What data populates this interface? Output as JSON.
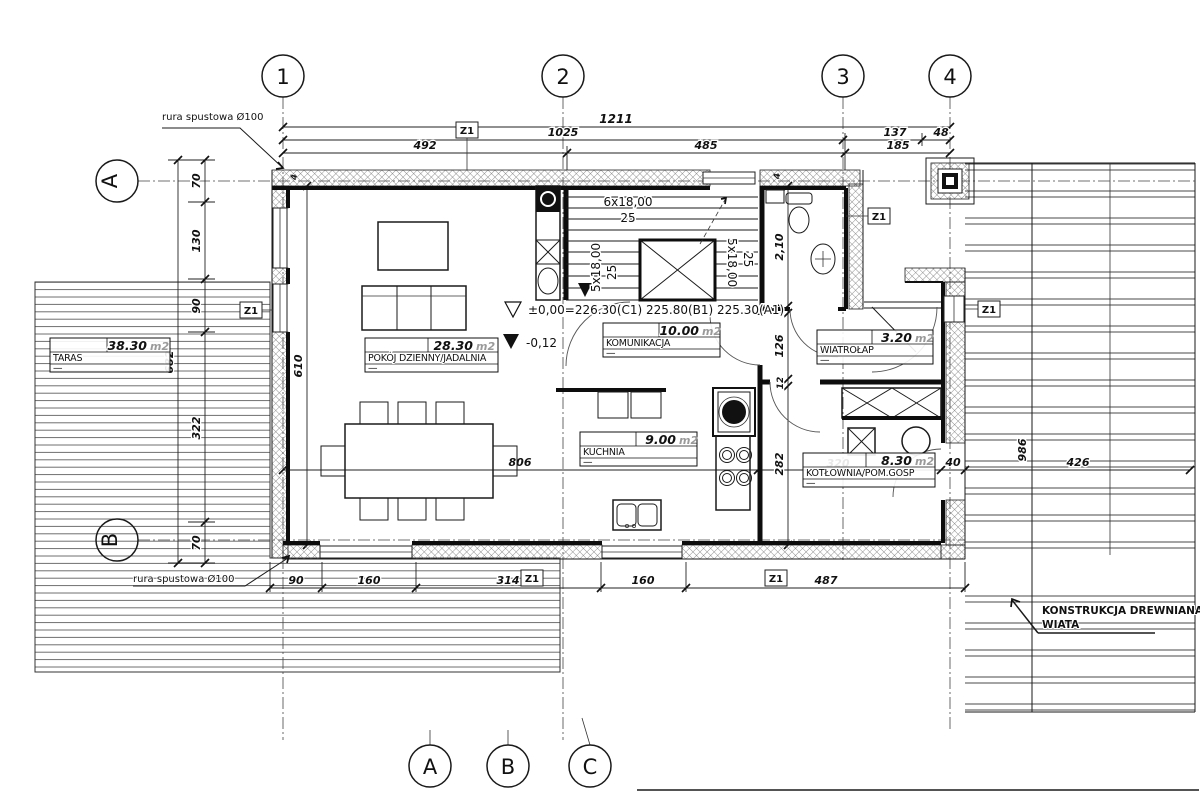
{
  "tags": {
    "window": "Z1"
  },
  "grids": {
    "top": [
      "1",
      "2",
      "3",
      "4"
    ],
    "left": [
      "A",
      "B"
    ],
    "bottom": [
      "A",
      "B",
      "C"
    ]
  },
  "rooms": {
    "taras": {
      "name": "TARAS",
      "area": "38.30",
      "unit": "m2",
      "dash": "—"
    },
    "pokoj": {
      "name": "POKÓJ DZIENNY/JADALNIA",
      "area": "28.30",
      "unit": "m2",
      "dash": "—"
    },
    "komunikacja": {
      "name": "KOMUNIKACJA",
      "area": "10.00",
      "unit": "m2",
      "dash": "—"
    },
    "kuchnia": {
      "name": "KUCHNIA",
      "area": "9.00",
      "unit": "m2",
      "dash": "—"
    },
    "wiatrolap": {
      "name": "WIATROŁAP",
      "area": "3.20",
      "unit": "m2",
      "dash": "—"
    },
    "kotlownia": {
      "name": "KOTŁOWNIA/POM.GOSP",
      "area": "8.30",
      "unit": "m2",
      "dash": "—"
    }
  },
  "levels": {
    "zero": "±0,00=226.30(C1)  225.80(B1)  225.30(A1)",
    "terrace": "-0,12"
  },
  "stairs": {
    "flight_top": "6x18,00",
    "tread_top": "25",
    "flight_left": "5x18,00",
    "tread_left": "25",
    "flight_right": "5x18,00",
    "tread_right": "25"
  },
  "notes": {
    "downpipe": "rura spustowa Ø100",
    "wiata_line1": "KONSTRUKCJA DREWNIANA",
    "wiata_line2": "WIATA"
  },
  "dims": {
    "top": {
      "total": "1211",
      "left_to_3": "1025",
      "seg_137": "137",
      "seg_48": "48",
      "seg_492": "492",
      "seg_485": "485",
      "seg_185": "185"
    },
    "left": {
      "seg_70a": "70",
      "seg_130": "130",
      "seg_90": "90",
      "seg_322": "322",
      "seg_70b": "70",
      "total": "682",
      "interior_610": "610"
    },
    "bottom": {
      "seg_90": "90",
      "seg_160a": "160",
      "seg_314": "314",
      "seg_160b": "160",
      "seg_487": "487"
    },
    "mid": {
      "interior_806": "806",
      "wall_40": "40",
      "wiata_426": "426",
      "wiata_986": "986"
    },
    "wing": {
      "bath_210": "2,10",
      "wall_12a": "12",
      "hall_126": "126",
      "wall_12b": "12",
      "kitchen_282": "282",
      "room_320": "320"
    },
    "misc": {
      "wall_4": "4"
    }
  }
}
